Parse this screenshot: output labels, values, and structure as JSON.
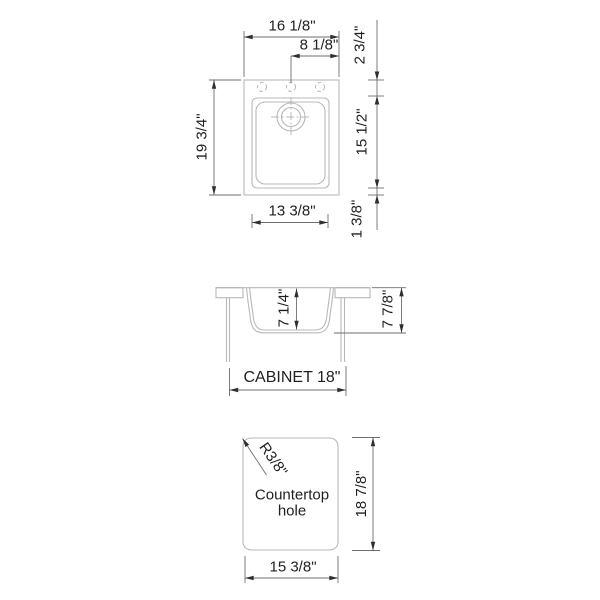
{
  "plan_view": {
    "overall_width": "16 1/8\"",
    "center_to_edge": "8 1/8\"",
    "overall_length": "19 3/4\"",
    "rim_to_bowl_top": "2 3/4\"",
    "bowl_length": "15 1/2\"",
    "bowl_width": "13 3/8\"",
    "bowl_to_rim_bottom": "1 3/8\""
  },
  "section_view": {
    "bowl_depth": "7 1/4\"",
    "overall_depth": "7 7/8\"",
    "cabinet_size": "CABINET 18\""
  },
  "cutout_view": {
    "corner_radius": "R3/8\"",
    "label_line1": "Countertop",
    "label_line2": "hole",
    "cutout_length": "18 7/8\"",
    "cutout_width": "15 3/8\""
  },
  "colors": {
    "background": "#ffffff",
    "object_line": "#b5b8bb",
    "dimension_line": "#6e6e6e",
    "arrow": "#2f2f2f",
    "text": "#1f1f1f"
  }
}
